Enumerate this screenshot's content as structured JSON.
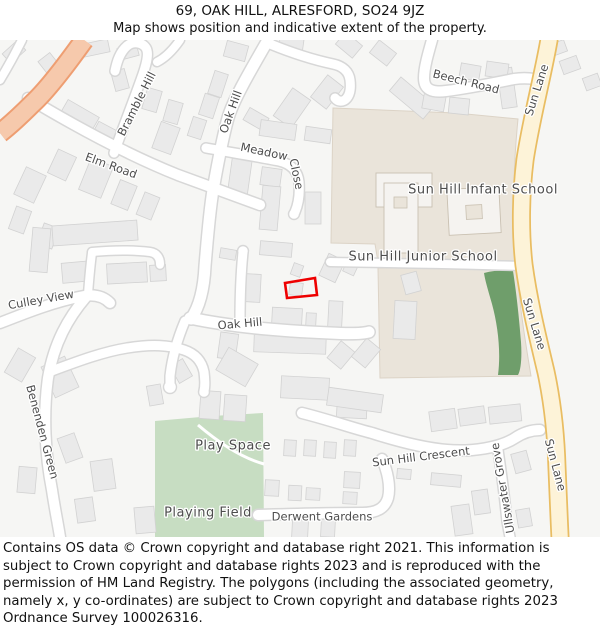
{
  "header": {
    "title": "69, OAK HILL, ALRESFORD, SO24 9JZ",
    "subtitle": "Map shows position and indicative extent of the property."
  },
  "map": {
    "labels": {
      "bramble_hill": "Bramble Hill",
      "oak_hill_north": "Oak Hill",
      "elm_road": "Elm Road",
      "meadow": "Meadow",
      "close": "Close",
      "beech_road": "Beech Road",
      "sun_lane_top": "Sun Lane",
      "sun_lane_mid": "Sun Lane",
      "sun_lane_bottom": "Sun Lane",
      "infant_school": "Sun Hill Infant School",
      "junior_school": "Sun Hill Junior School",
      "culley_view": "Culley View",
      "oak_hill_west": "Oak Hill",
      "benenden_green": "Benenden Green",
      "play_space": "Play Space",
      "playing_field": "Playing Field",
      "sun_hill_crescent": "Sun Hill Crescent",
      "ullswater_grove": "Ullswater Grove",
      "derwent_gardens": "Derwent Gardens"
    },
    "colors": {
      "background": "#f6f6f4",
      "road_fill": "#ffffff",
      "road_casing": "#d7d7d7",
      "building_fill": "#eaeaea",
      "building_stroke": "#d2d2d2",
      "school_area": "#eae4da",
      "school_building": "#f5f3f0",
      "green_light": "#c7ddc2",
      "green_dark": "#6f9e6b",
      "primary_road_fill": "#fdf3d8",
      "primary_road_casing": "#e9bd62",
      "secondary_road_fill": "#f6c9ac",
      "secondary_road_casing": "#ee9e72",
      "property_outline": "#ee0000",
      "label": "#4d4d4d"
    }
  },
  "footer": {
    "text": "Contains OS data © Crown copyright and database right 2021. This information is subject to Crown copyright and database rights 2023 and is reproduced with the permission of HM Land Registry. The polygons (including the associated geometry, namely x, y co-ordinates) are subject to Crown copyright and database rights 2023 Ordnance Survey 100026316."
  }
}
